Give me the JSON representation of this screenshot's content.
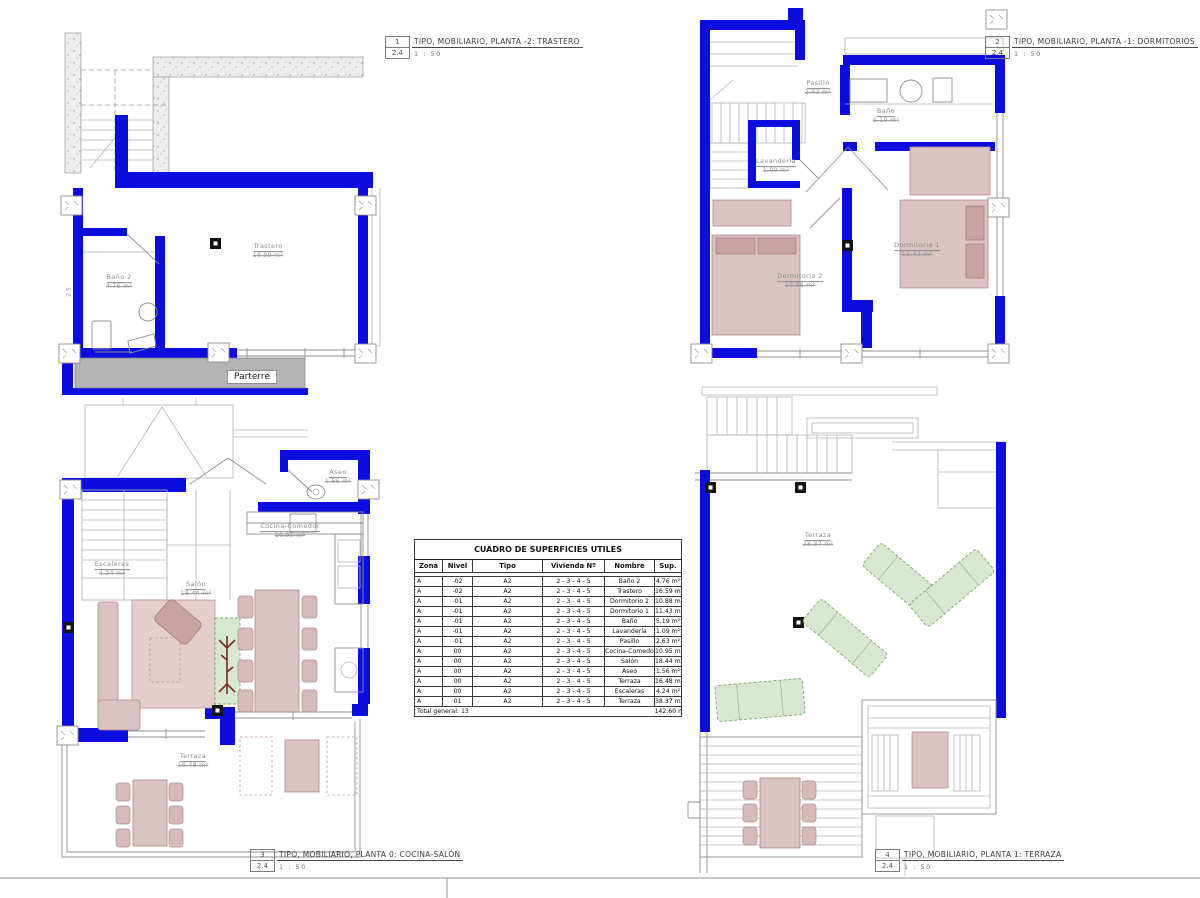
{
  "colors": {
    "wall_blue": "#0d0de0",
    "furniture_pink": "#dcc3c3",
    "furniture_pink_dark": "#c9a2a2",
    "furniture_green": "#d8e7d0",
    "parterre_gray": "#b3b3b3",
    "line_gray": "#8f8f8f"
  },
  "plans": [
    {
      "tag": "1",
      "sheet": "2.4",
      "scale": "1 : 50",
      "title": "TIPO, MOBILIARIO, PLANTA -2: TRASTERO",
      "rooms": [
        {
          "name": "Baño 2",
          "area": "4.76 m²"
        },
        {
          "name": "Trastero",
          "area": "16.59 m²"
        }
      ],
      "labels": {
        "parterre": "Parterre",
        "dim": "2.5"
      }
    },
    {
      "tag": "2",
      "sheet": "2.4",
      "scale": "1 : 50",
      "title": "TIPO, MOBILIARIO, PLANTA -1: DORMITORIOS",
      "rooms": [
        {
          "name": "Pasillo",
          "area": "2.63 m²"
        },
        {
          "name": "Baño",
          "area": "5.19 m²"
        },
        {
          "name": "Lavandería",
          "area": "1.09 m²"
        },
        {
          "name": "Dormitorio 2",
          "area": "10.88 m²"
        },
        {
          "name": "Dormitorio 1",
          "area": "11.43 m²"
        }
      ]
    },
    {
      "tag": "3",
      "sheet": "2.4",
      "scale": "1 : 50",
      "title": "TIPO, MOBILIARIO, PLANTA 0: COCINA-SALÓN",
      "rooms": [
        {
          "name": "Aseo",
          "area": "1.56 m²"
        },
        {
          "name": "Cocina-Comedor",
          "area": "10.95 m²"
        },
        {
          "name": "Escaleras",
          "area": "4.24 m²"
        },
        {
          "name": "Salón",
          "area": "18.44 m²"
        },
        {
          "name": "Terraza",
          "area": "16.48 m²"
        }
      ]
    },
    {
      "tag": "4",
      "sheet": "2.4",
      "scale": "1 : 50",
      "title": "TIPO, MOBILIARIO, PLANTA 1: TERRAZA",
      "rooms": [
        {
          "name": "Terraza",
          "area": "38.37 m²"
        }
      ]
    }
  ],
  "table": {
    "title": "CUADRO DE SUPERFICIES UTILES",
    "headers": [
      "Zona",
      "Nivel",
      "Tipo",
      "Vivienda Nº",
      "Nombre",
      "Sup."
    ],
    "rows": [
      [
        "A",
        "-02",
        "A2",
        "2 - 3 - 4 - 5",
        "Baño 2",
        "4.76 m²"
      ],
      [
        "A",
        "-02",
        "A2",
        "2 - 3 - 4 - 5",
        "Trastero",
        "16.59 m²"
      ],
      [
        "A",
        "-01",
        "A2",
        "2 - 3 - 4 - 5",
        "Dormitorio 2",
        "10.88 m²"
      ],
      [
        "A",
        "-01",
        "A2",
        "2 - 3 - 4 - 5",
        "Dormitorio 1",
        "11.43 m²"
      ],
      [
        "A",
        "-01",
        "A2",
        "2 - 3 - 4 - 5",
        "Baño",
        "5.19 m²"
      ],
      [
        "A",
        "-01",
        "A2",
        "2 - 3 - 4 - 5",
        "Lavandería",
        "1.09 m²"
      ],
      [
        "A",
        "-01",
        "A2",
        "2 - 3 - 4 - 5",
        "Pasillo",
        "2.63 m²"
      ],
      [
        "A",
        "00",
        "A2",
        "2 - 3 - 4 - 5",
        "Cocina-Comedor",
        "10.95 m²"
      ],
      [
        "A",
        "00",
        "A2",
        "2 - 3 - 4 - 5",
        "Salón",
        "18.44 m²"
      ],
      [
        "A",
        "00",
        "A2",
        "2 - 3 - 4 - 5",
        "Aseo",
        "1.56 m²"
      ],
      [
        "A",
        "00",
        "A2",
        "2 - 3 - 4 - 5",
        "Terraza",
        "16.48 m²"
      ],
      [
        "A",
        "00",
        "A2",
        "2 - 3 - 4 - 5",
        "Escaleras",
        "4.24 m²"
      ],
      [
        "A",
        "01",
        "A2",
        "2 - 3 - 4 - 5",
        "Terraza",
        "38.37 m²"
      ]
    ],
    "total_label": "Total general: 13",
    "total_value": "142.60 m²"
  }
}
